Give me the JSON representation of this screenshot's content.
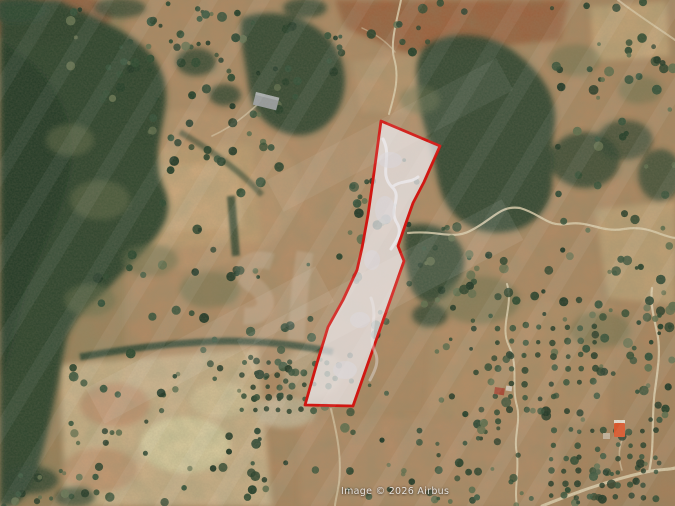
{
  "map": {
    "view_type": "satellite-imagery",
    "attribution": "Image © 2026 Airbus",
    "parcel": {
      "outline_color": "#d01712",
      "fill_color": "rgba(235,233,237,0.72)",
      "stroke_width": 2.8,
      "points": [
        [
          381,
          121
        ],
        [
          440,
          146
        ],
        [
          424,
          182
        ],
        [
          413,
          203
        ],
        [
          407,
          220
        ],
        [
          398,
          246
        ],
        [
          404,
          261
        ],
        [
          353,
          406
        ],
        [
          305,
          405
        ],
        [
          317,
          363
        ],
        [
          328,
          327
        ],
        [
          343,
          300
        ],
        [
          357,
          270
        ],
        [
          362,
          248
        ],
        [
          368,
          215
        ],
        [
          373,
          180
        ]
      ]
    },
    "palette": {
      "terrain_tan": "#b08a64",
      "terrain_pale": "#d5c195",
      "terrain_red": "#96512f",
      "forest_green": "#2b4531",
      "road_light": "#ded2b2",
      "attribution_text_color": "#ffffff"
    },
    "watermark": {
      "present": true,
      "style": "diagonal-translucent-stripes"
    }
  }
}
